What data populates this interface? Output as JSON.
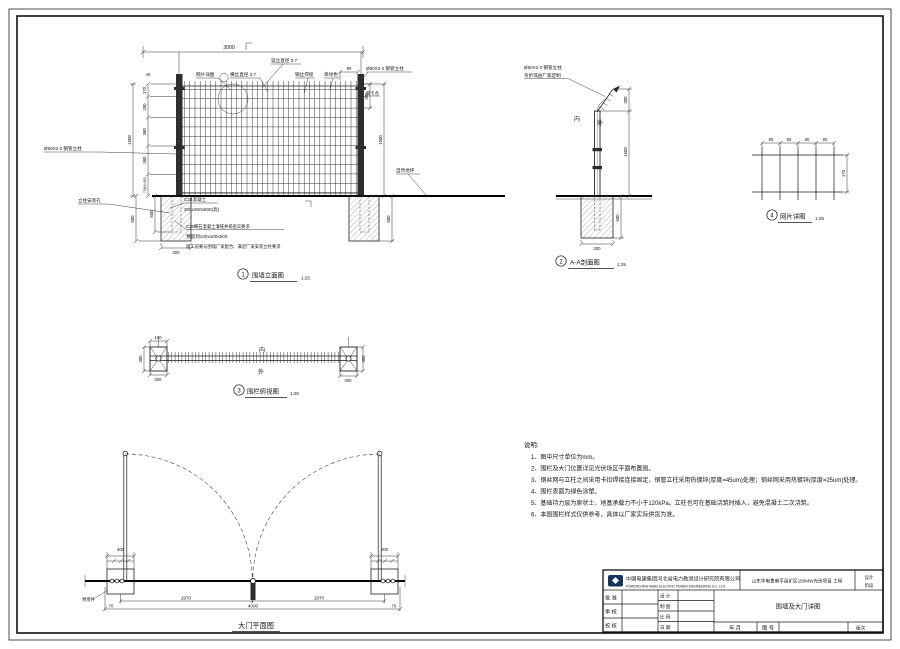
{
  "colors": {
    "line": "#1b1b1b",
    "logo": "#15335e",
    "paper": "#ffffff"
  },
  "elevation": {
    "title_no": "1",
    "title": "围墙立面图",
    "scale": "1:25",
    "dim_top": "3000",
    "dim_40": "40",
    "dim_90": "90",
    "dim_300_top": "300",
    "dim_1500_right": "1500",
    "dim_600_right": "600",
    "dim_1500_left": "1500",
    "dims_left": [
      "170",
      "280",
      "380",
      "380",
      "75@4=300"
    ],
    "dim_600_left": "600",
    "dim_500": "500",
    "dim_300_found": "300",
    "label_mesh_callout": "网片详图",
    "label_horiz": "横丝直径 3.7",
    "label_vert": "竖丝直径 3.7",
    "label_weld": "钢丝焊接",
    "label_green": "草绿色",
    "label_post": "Ø50X2.0 钢管立柱",
    "label_clip": "带卡点",
    "label_ground": "自然地坪",
    "label_hole": "立柱安装孔",
    "c25_1": "C25混凝土",
    "c25_2": "300x300x600(高)",
    "c25_3": "C25细石混凝土灌缝并捣密实要求",
    "c25_4": "预留洞100x100x500",
    "c25_5": "施工前要与围墙厂家配合、满足厂家安装立柱要求"
  },
  "section": {
    "title_no": "2",
    "title": "A-A剖面图",
    "scale": "1:25",
    "label_post": "Ø50X2.0 钢管立柱",
    "label_bend": "弯折或由厂家定制",
    "label_in": "内",
    "label_out": "外",
    "dim_300_top": "300",
    "dim_1500": "1500",
    "dim_600": "600",
    "dim_300_bot": "300"
  },
  "mesh_detail": {
    "title_no": "4",
    "title": "网片详图",
    "scale": "1:25",
    "dim_90": "90",
    "dim_170": "170"
  },
  "plan": {
    "title_no": "3",
    "title": "围栏俯视图",
    "scale": "1:25",
    "label_in": "内",
    "label_out": "外",
    "dim_100": "100",
    "dim_300_l": "300",
    "dim_300_lb": "300",
    "dim_300_r": "300",
    "dim_300_rb": "300"
  },
  "gate": {
    "title": "大门平面图",
    "dim_400": "400",
    "dim_leaf_l": "1970",
    "dim_leaf_r": "1970",
    "dim_total": "4000",
    "dim_70": "70",
    "label_embed": "预埋件"
  },
  "notes": {
    "title": "说明:",
    "items": [
      "1、图中尺寸单位为mm。",
      "2、围栏及大门位置详见光伏场区平面布置图。",
      "3、钢丝网与立柱之间采用卡扣焊接连接固定，钢管立柱采用热镀锌(厚度=45um)处理；钢丝网采用热镀锌(厚度=25um)处理。",
      "4、围栏表面为绿色涂塑。",
      "5、基础持力层为原状土，地基承载力不小于120kPa。立柱也可在基础浇筑时插入，避免混凝土二次浇筑。",
      "6、本图围栏样式仅供参考，具体以厂家实际供货为准。"
    ]
  },
  "title_block": {
    "company_cn": "中国电建集团河北省电力勘测设计研究院有限公司",
    "company_en": "POWERCHINA HEBEI ELECTRIC POWER ENGINEERING CO., LTD.",
    "project": "山东华电鲁南平邑矿区150MW光伏项目 工程",
    "stage_1": "设计",
    "stage_2": "阶段",
    "row_approve": "批 准",
    "row_review": "审 核",
    "row_check": "校 核",
    "col_design": "设 计",
    "col_draft": "制 图",
    "col_scale": "比 例",
    "col_date": "日 期",
    "drawing_title": "围墙及大门详图",
    "bottom_ym": "年  月",
    "bottom_no": "图 号",
    "revision": "版次"
  }
}
